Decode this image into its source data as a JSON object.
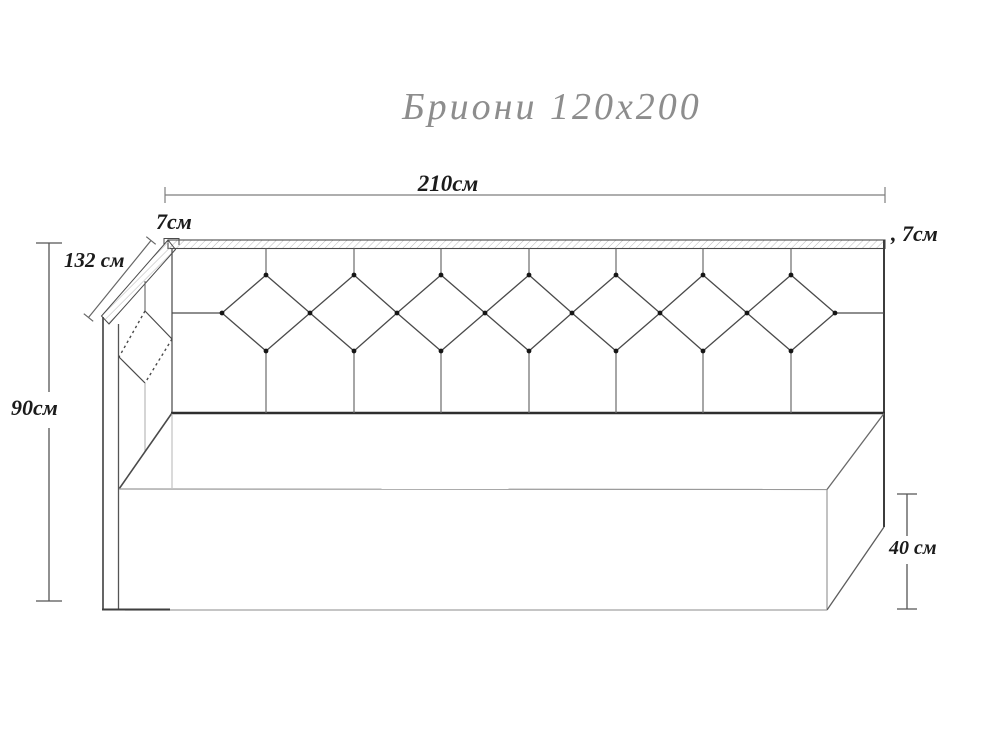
{
  "title": "Бриони 120x200",
  "labels": {
    "width_total": "210см",
    "rail_thickness_left": "7см",
    "rail_thickness_right": ", 7см",
    "side_depth": "132 см",
    "height_total": "90см",
    "base_height": "40 см"
  },
  "colors": {
    "background": "#ffffff",
    "line_dark": "#2e2e2e",
    "line_mid": "#555555",
    "line_light": "#9a9a9a",
    "hatch": "#b9b9b9",
    "title_text": "#8d8d8d",
    "dimension_text": "#1b1b1b",
    "button_dot": "#161616"
  },
  "drawing": {
    "headboard_diamond_count": 7,
    "side_panel_diamond_count": 1,
    "button_dots": {
      "top_row": 7,
      "middle_row": 8,
      "bottom_row": 7
    }
  }
}
